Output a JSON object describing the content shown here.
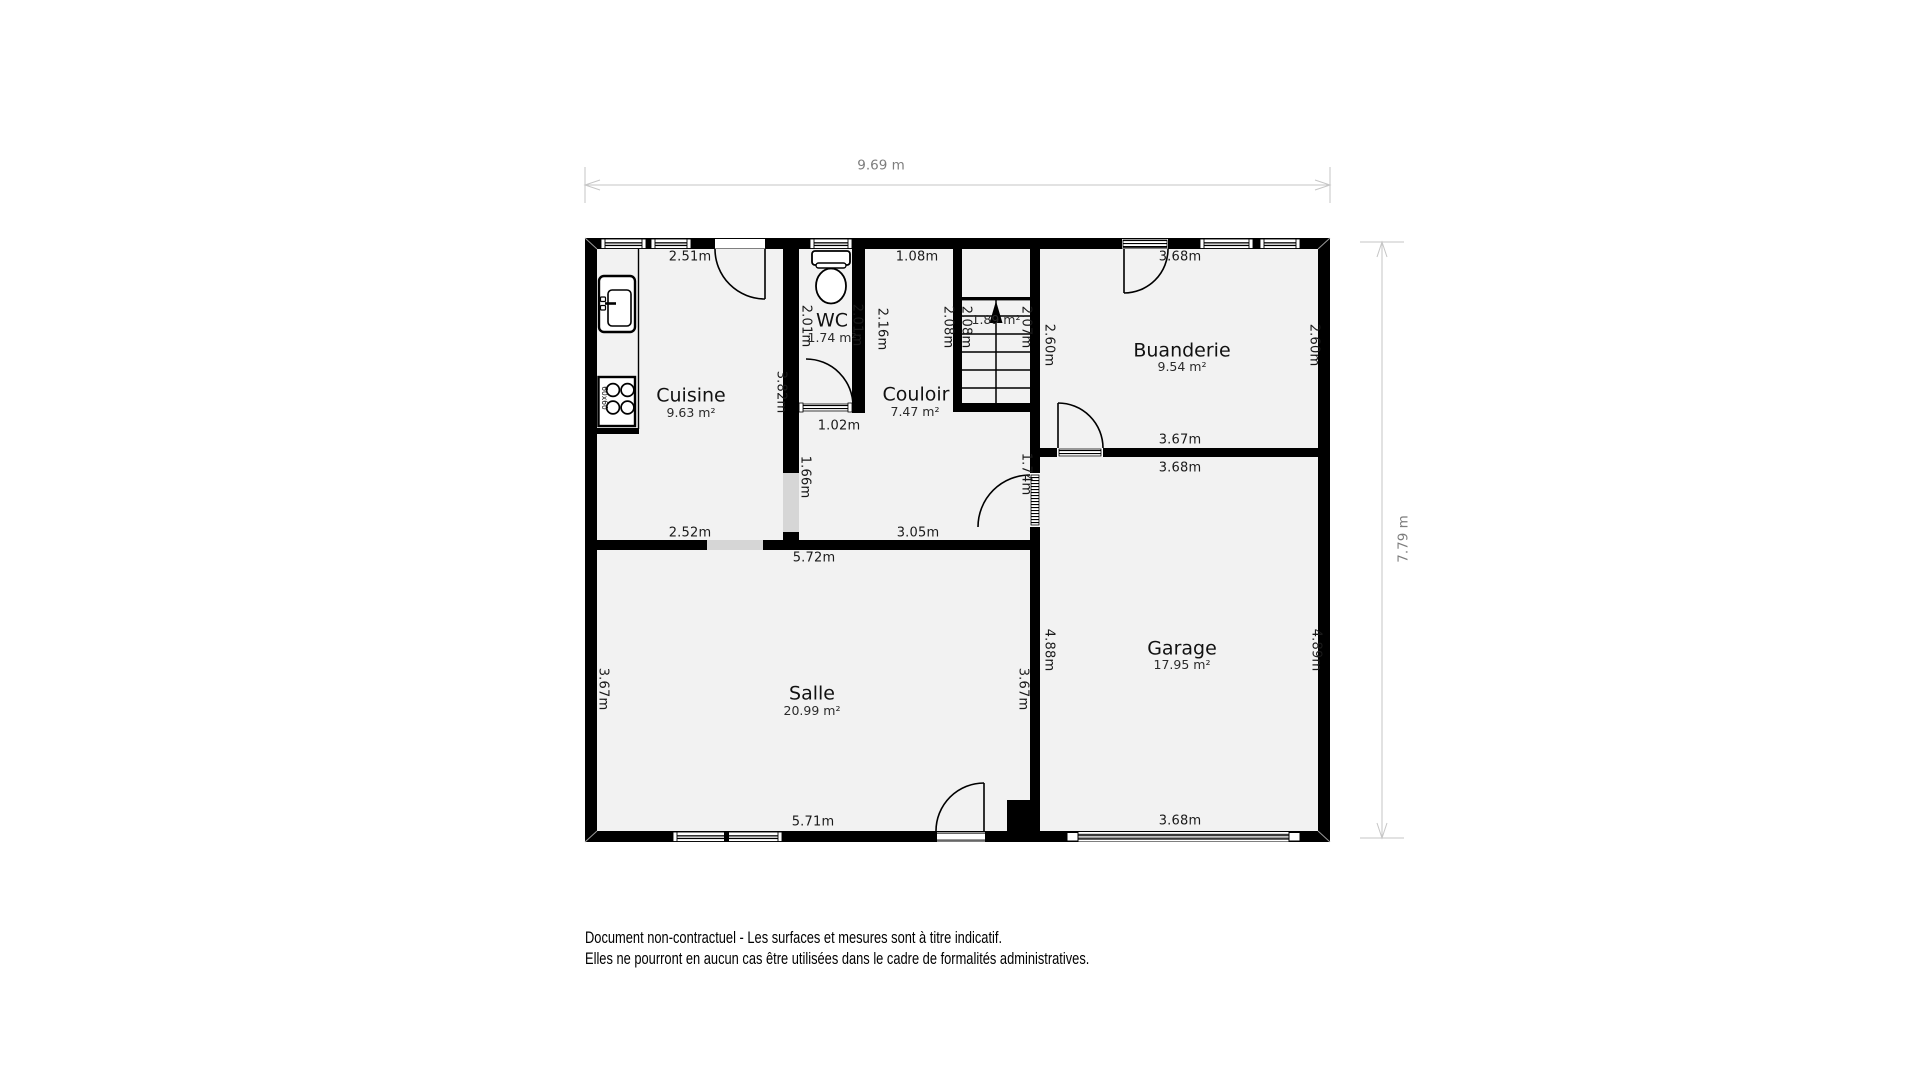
{
  "document": {
    "disclaimer_line1": "Document non-contractuel - Les surfaces et mesures sont à titre indicatif.",
    "disclaimer_line2": "Elles ne pourront en aucun cas être utilisées dans le cadre de formalités administratives."
  },
  "plan": {
    "overall_width": "9.69 m",
    "overall_height": "7.79 m",
    "rooms": {
      "cuisine": {
        "name": "Cuisine",
        "area": "9.63 m²"
      },
      "wc": {
        "name": "WC",
        "area": "1.74 m²"
      },
      "couloir": {
        "name": "Couloir",
        "area": "7.47 m²"
      },
      "escalier": {
        "area": "1.89 m²"
      },
      "buanderie": {
        "name": "Buanderie",
        "area": "9.54 m²"
      },
      "salle": {
        "name": "Salle",
        "area": "20.99 m²"
      },
      "garage": {
        "name": "Garage",
        "area": "17.95 m²"
      }
    },
    "dimensions": {
      "cuisine_top": "2.51m",
      "cuisine_right": "3.82m",
      "cuisine_bottom": "2.52m",
      "wc_left": "2.01m",
      "wc_right": "2.01m",
      "wc_door": "1.02m",
      "couloir_top": "1.08m",
      "couloir_wall_upper": "2.16m",
      "couloir_wall_lower": "1.66m",
      "couloir_right": "2.08m",
      "couloir_bottom": "3.05m",
      "couloir_garage_door": "1.74m",
      "stairs_left": "2.08m",
      "stairs_right": "2.07m",
      "buanderie_top": "3.68m",
      "buanderie_left": "2.60m",
      "buanderie_right": "2.60m",
      "buanderie_bottom": "3.67m",
      "garage_top": "3.68m",
      "garage_left": "4.88m",
      "garage_right": "4.89m",
      "garage_bottom": "3.68m",
      "salle_top": "5.72m",
      "salle_left": "3.67m",
      "salle_right": "3.67m",
      "salle_bottom": "5.71m"
    },
    "fixtures": {
      "stove_size": "60x60"
    },
    "colors": {
      "wall": "#000000",
      "floor": "#f2f2f2",
      "opening": "#d6d6d6",
      "dimension_line": "#c6c6c6"
    }
  }
}
